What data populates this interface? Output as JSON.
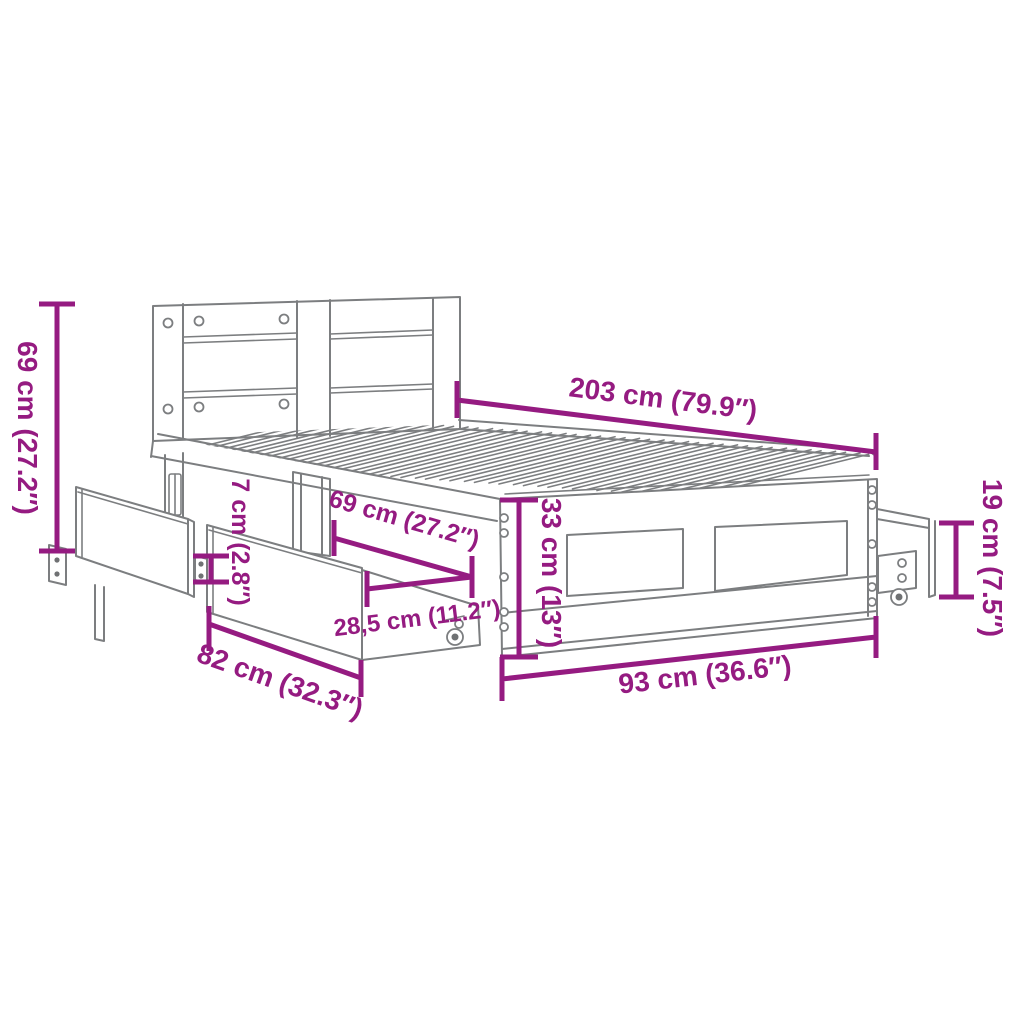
{
  "colors": {
    "dimension": "#951B81",
    "drawing_line": "#7C7E80",
    "background": "#FFFFFF"
  },
  "dimensions": {
    "length": {
      "value": "203 cm (79.9″)"
    },
    "headboard_height": {
      "value": "69 cm (27.2″)"
    },
    "rail_gap": {
      "value": "7 cm (2.8″)"
    },
    "inner_width": {
      "value": "69 cm (27.2″)"
    },
    "drawer_height": {
      "value": "28,5 cm (11.2″)"
    },
    "drawer_depth": {
      "value": "82 cm (32.3″)"
    },
    "frame_height": {
      "value": "33 cm (13″)"
    },
    "width": {
      "value": "93 cm (36.6″)"
    },
    "footend_height": {
      "value": "19 cm (7.5″)"
    }
  }
}
